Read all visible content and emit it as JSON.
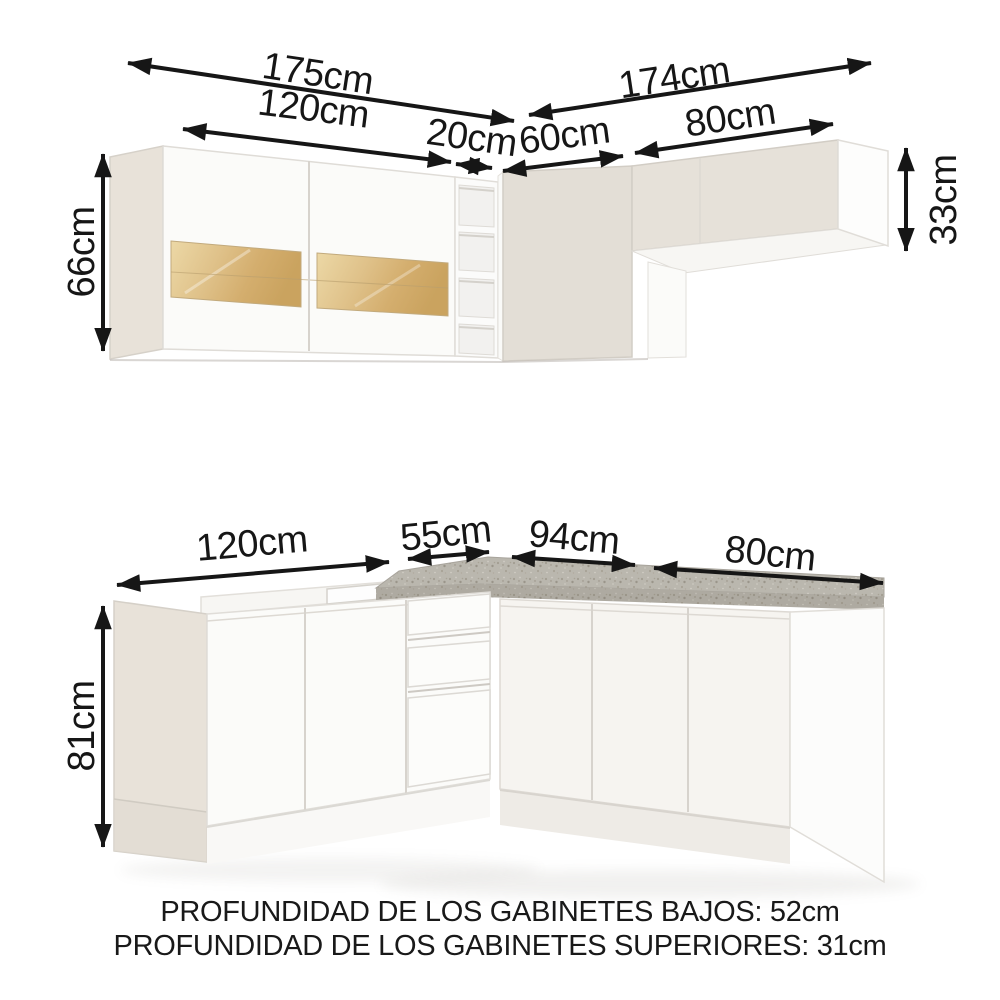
{
  "title": "Kitchen cabinet dimensions diagram",
  "upper": {
    "total_left": "175cm",
    "glass_cabinet": "120cm",
    "shelf": "20cm",
    "corner": "60cm",
    "total_right": "174cm",
    "right_cabinet": "80cm",
    "height_left": "66cm",
    "height_right": "33cm"
  },
  "lower": {
    "left_section": "120cm",
    "drawer_section": "55cm",
    "corner_section": "94cm",
    "right_section": "80cm",
    "height": "81cm"
  },
  "footer": {
    "line1": "PROFUNDIDAD DE LOS GABINETES BAJOS: 52cm",
    "line2": "PROFUNDIDAD DE LOS GABINETES SUPERIORES: 31cm"
  },
  "colors": {
    "dimension": "#161616",
    "granite_base": "#bab7ae",
    "beige_side": "#e8e2d9",
    "beige_front": "#e3ded6",
    "beige_front_light": "#e6e1d9",
    "white_front": "#fbfbf9",
    "wood_glass": "#d4ae6e"
  }
}
